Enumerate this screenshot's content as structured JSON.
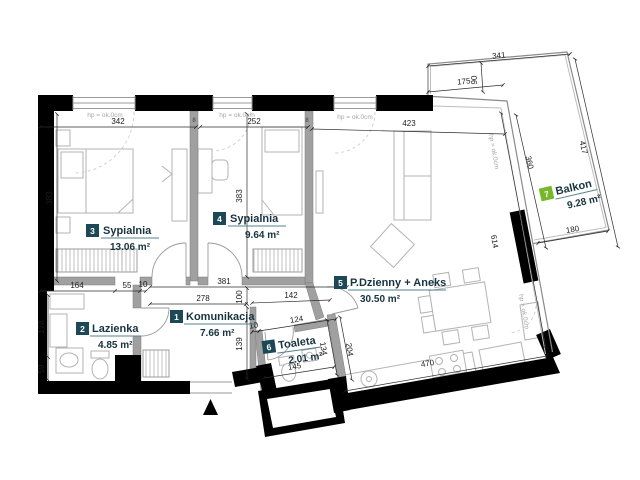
{
  "title": "Rzut mieszkania (floor plan)",
  "rooms": [
    {
      "num": "1",
      "name": "Komunikacja",
      "area": "7.66 m²"
    },
    {
      "num": "2",
      "name": "Lazienka",
      "area": "4.85 m²"
    },
    {
      "num": "3",
      "name": "Sypialnia",
      "area": "13.06 m²"
    },
    {
      "num": "4",
      "name": "Sypialnia",
      "area": "9.64 m²"
    },
    {
      "num": "5",
      "name": "P.Dzienny + Aneks",
      "area": "30.50 m²"
    },
    {
      "num": "6",
      "name": "Toaleta",
      "area": "2.01 m²"
    },
    {
      "num": "7",
      "name": "Balkon",
      "area": "9.28 m²"
    }
  ],
  "dims": {
    "d342": "342",
    "d252": "252",
    "d423": "423",
    "d341": "341",
    "d175": "175",
    "d90": "90",
    "d417": "417",
    "d360": "360",
    "d180": "180",
    "d614": "614",
    "d383a": "383",
    "d383b": "383",
    "d178": "178",
    "d59": "59",
    "d164": "164",
    "d55": "55",
    "d10a": "10",
    "d10b": "10",
    "d381": "381",
    "d278": "278",
    "d100": "100",
    "d142": "142",
    "d139": "139",
    "d124": "124",
    "d134": "134",
    "d204": "204",
    "d145": "145",
    "d470": "470",
    "d8a": "8",
    "d8b": "8"
  },
  "labels": {
    "hp": "hp = ok.0cm"
  },
  "colors": {
    "badge_teal": "#1d4956",
    "badge_green": "#76b82a",
    "label_text": "#17333f",
    "wall": "#000000",
    "partition": "#a0a0a0",
    "dimension": "#1c1c1c"
  }
}
